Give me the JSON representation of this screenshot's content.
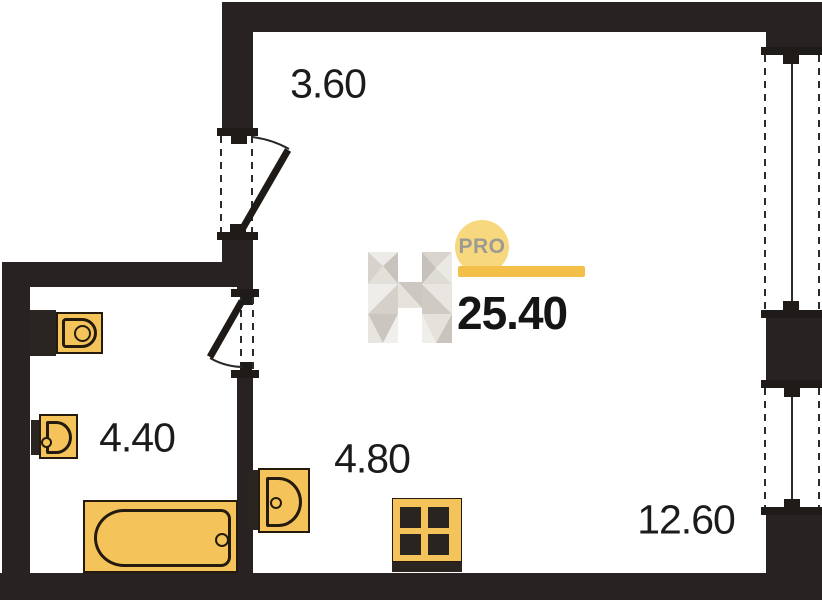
{
  "logo": {
    "letter": "H",
    "badge": "PRO"
  },
  "total_area": "25.40",
  "rooms": {
    "hallway": {
      "area": "3.60"
    },
    "bathroom": {
      "area": "4.40"
    },
    "kitchen": {
      "area": "4.80"
    },
    "living": {
      "area": "12.60"
    }
  },
  "fixtures": [
    "toilet-icon",
    "washbasin-icon",
    "bathtub-icon",
    "kitchen-sink-icon",
    "stove-icon"
  ],
  "colors": {
    "wall": "#282322",
    "fixture_fill": "#F4C35A",
    "fixture_outline": "#241b0e",
    "badge_circle": "#F8D87E",
    "badge_bar": "#F3BF48",
    "badge_text": "#9B9B93",
    "label_text": "#1b1b1b"
  }
}
